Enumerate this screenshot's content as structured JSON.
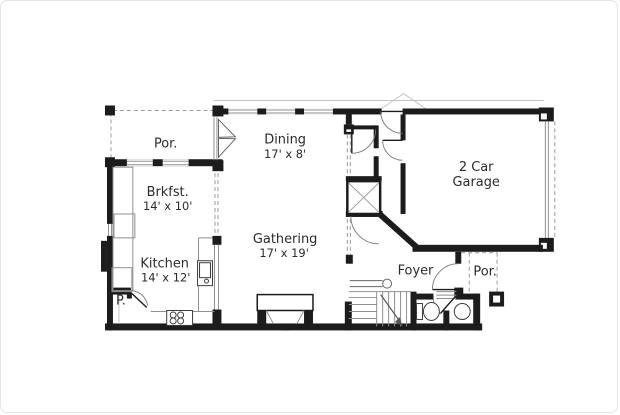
{
  "colors": {
    "background": "#ffffff",
    "frame": "#e5e5e5",
    "wall": "#1c1c1c",
    "thin": "#8f8f8f",
    "light": "#c4c4c4",
    "dash": "#9a9a9a",
    "text": "#2b2b2b"
  },
  "rooms": {
    "porch_left": {
      "name": "Por."
    },
    "dining": {
      "name": "Dining",
      "size": "17' x 8'"
    },
    "garage": {
      "line1": "2 Car",
      "line2": "Garage"
    },
    "brkfst": {
      "name": "Brkfst.",
      "size": "14' x 10'"
    },
    "kitchen": {
      "name": "Kitchen",
      "size": "14' x 12'"
    },
    "gathering": {
      "name": "Gathering",
      "size": "17' x 19'"
    },
    "foyer": {
      "name": "Foyer"
    },
    "porch_right": {
      "name": "Por."
    },
    "pantry": {
      "name": "P."
    }
  }
}
